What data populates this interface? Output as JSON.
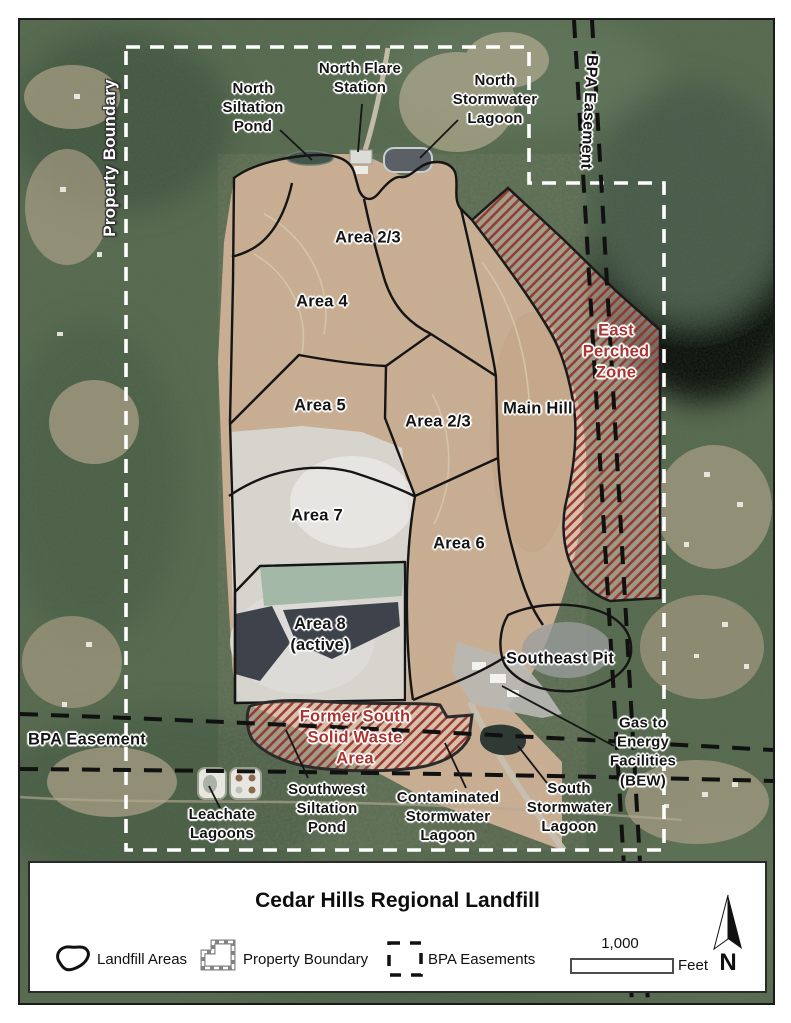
{
  "map": {
    "boundary_labels": {
      "property_boundary_vertical": "Property Boundary",
      "bpa_easement_vertical": "BPA Easement",
      "bpa_easement_left": "BPA Easement"
    },
    "facility_labels": {
      "north_siltation_pond": "North\nSiltation\nPond",
      "north_flare_station": "North Flare\nStation",
      "north_stormwater_lagoon": "North\nStormwater\nLagoon",
      "gas_to_energy": "Gas to\nEnergy\nFacilities\n(BEW)",
      "leachate_lagoons": "Leachate\nLagoons",
      "southwest_siltation_pond": "Southwest\nSiltation\nPond",
      "contaminated_stormwater_lagoon": "Contaminated\nStormwater\nLagoon",
      "south_stormwater_lagoon": "South\nStormwater\nLagoon"
    },
    "area_labels": {
      "area_23_north": "Area 2/3",
      "area_4": "Area 4",
      "area_5": "Area 5",
      "area_23_central": "Area 2/3",
      "main_hill": "Main Hill",
      "area_7": "Area 7",
      "area_6": "Area 6",
      "area_8": "Area 8\n(active)",
      "southeast_pit": "Southeast Pit",
      "east_perched_zone": "East\nPerched\nZone",
      "former_south_solid_waste": "Former South\nSolid Waste\nArea"
    },
    "colors": {
      "hatch_red": "#98302b",
      "red_label": "#a93430",
      "property_boundary_white": "#ffffff",
      "bpa_easement_black": "#111111",
      "area_outline_black": "#151515"
    }
  },
  "legend": {
    "title": "Cedar Hills Regional Landfill",
    "items": [
      {
        "id": "landfill-areas",
        "label": "Landfill Areas"
      },
      {
        "id": "property-boundary",
        "label": "Property Boundary"
      },
      {
        "id": "bpa-easements",
        "label": "BPA Easements"
      }
    ],
    "scale_bar": {
      "value": "1,000",
      "unit": "Feet"
    },
    "north_label": "N"
  }
}
